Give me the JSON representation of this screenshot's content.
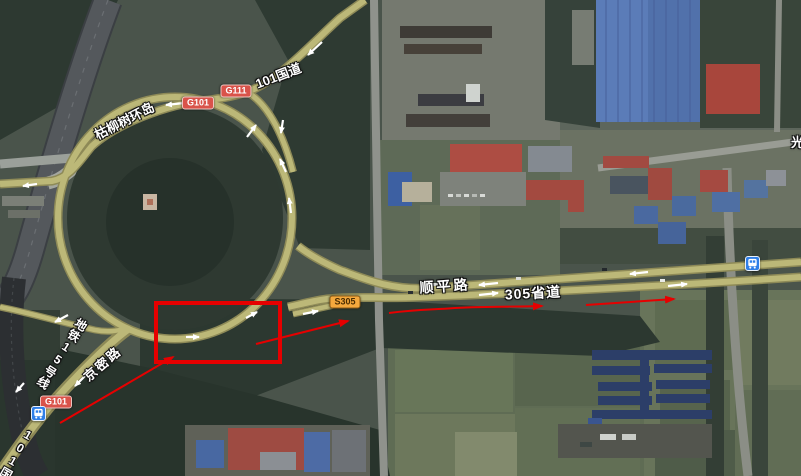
{
  "map": {
    "view_type": "satellite",
    "place_labels": {
      "roundabout_name": "枯柳树环岛",
      "national_road_101_northeast": "101国道",
      "shunping_road": "顺平路",
      "provincial_road_305": "305省道",
      "jingmi_road": "京密路",
      "metro_line_15": "地铁15号线",
      "national_road_101_southwest": "101国道",
      "partial_label_right_edge": "光"
    },
    "road_shields": {
      "g101_north": "G101",
      "g111": "G111",
      "s305": "S305",
      "g101_south": "G101"
    },
    "colors": {
      "road_overlay_olive": "#bcb878",
      "annotation_red": "#e60000",
      "national_shield_red": "#d9534a",
      "provincial_shield_orange": "#f4a83d",
      "transit_icon_blue": "#2f7fe8"
    },
    "annotations": {
      "rectangle_path": "M156,303 L280,303 L280,362 L156,362 Z",
      "arrow_a_path": "M60,423 L173,357",
      "arrow_b_path": "M256,344 L348,321",
      "arrow_c_path": "M389,313 C420,309 430,310 455,308 C490,306 515,307 542,306",
      "arrow_d_path": "M586,305 L674,299"
    }
  }
}
